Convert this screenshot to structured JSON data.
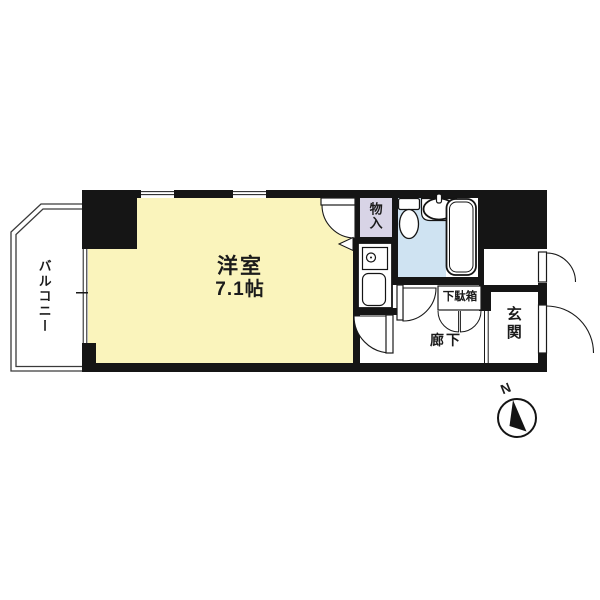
{
  "rooms": {
    "main_room": {
      "name": "洋室",
      "area": "7.1帖"
    },
    "balcony": {
      "name": "バルコニー"
    },
    "storage": {
      "name": "物入"
    },
    "hallway": {
      "name": "廊下"
    },
    "entrance": {
      "name": "玄関"
    },
    "shoe_cabinet": {
      "name": "下駄箱"
    }
  },
  "compass": {
    "north": "N"
  },
  "colors": {
    "main_room_fill": "#faf4bc",
    "storage_fill": "#d8d4e6",
    "bathroom_fill": "#cfe3f2",
    "wall": "#151515",
    "background": "#ffffff"
  }
}
